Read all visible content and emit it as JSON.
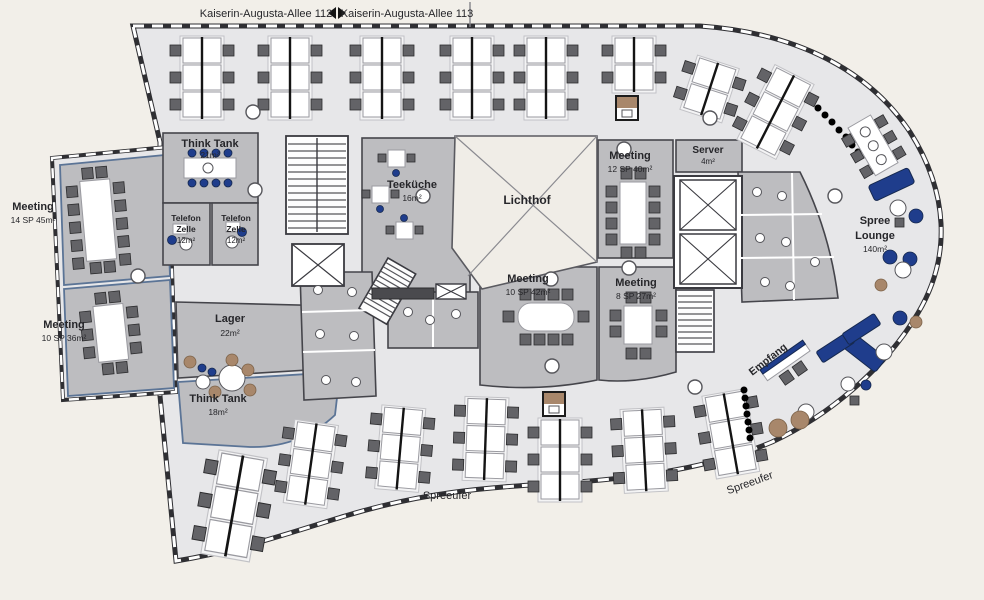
{
  "palette": {
    "background": "#f2efe9",
    "floor": "#e7e7e9",
    "room_fill": "#bdbdc0",
    "wall": "#2f2f33",
    "accent_blue": "#1f3d8c",
    "chair_gray": "#636367",
    "tan": "#a8876b"
  },
  "streets": {
    "kaiserin_112": "Kaiserin-Augusta-Allee 112",
    "kaiserin_113": "Kaiserin-Augusta-Allee 113",
    "spreeufer_center": "Spreeufer",
    "spreeufer_right": "Spreeufer"
  },
  "icons": {
    "street_arrows": "left-right-arrow-pair"
  },
  "labels": {
    "meeting_left_top": {
      "line1": "Meeting",
      "line2": "14 SP 45m²"
    },
    "meeting_left_bottom": {
      "line1": "Meeting",
      "line2": "10 SP 36m²"
    },
    "think_tank_top": {
      "line1": "Think Tank",
      "line2": "21m²"
    },
    "telefon_zelle_left": {
      "line1": "Telefon",
      "line2": "Zelle",
      "line3": "12m²"
    },
    "telefon_zelle_right": {
      "line1": "Telefon",
      "line2": "Zelle",
      "line3": "12m²"
    },
    "teekueche": {
      "line1": "Teeküche",
      "line2": "16m²"
    },
    "lichthof": {
      "line1": "Lichthof"
    },
    "meeting_center_top": {
      "line1": "Meeting",
      "line2": "12 SP 40m²"
    },
    "server": {
      "line1": "Server",
      "line2": "4m²"
    },
    "meeting_center_left": {
      "line1": "Meeting",
      "line2": "10 SP 42m²"
    },
    "meeting_center_right": {
      "line1": "Meeting",
      "line2": "8 SP 27m²"
    },
    "lager": {
      "line1": "Lager",
      "line2": "22m²"
    },
    "think_tank_bottom": {
      "line1": "Think Tank",
      "line2": "18m²"
    },
    "spree_lounge": {
      "line1": "Spree",
      "line2": "Lounge",
      "line3": "140m²"
    },
    "empfang": {
      "line1": "Empfang"
    }
  }
}
